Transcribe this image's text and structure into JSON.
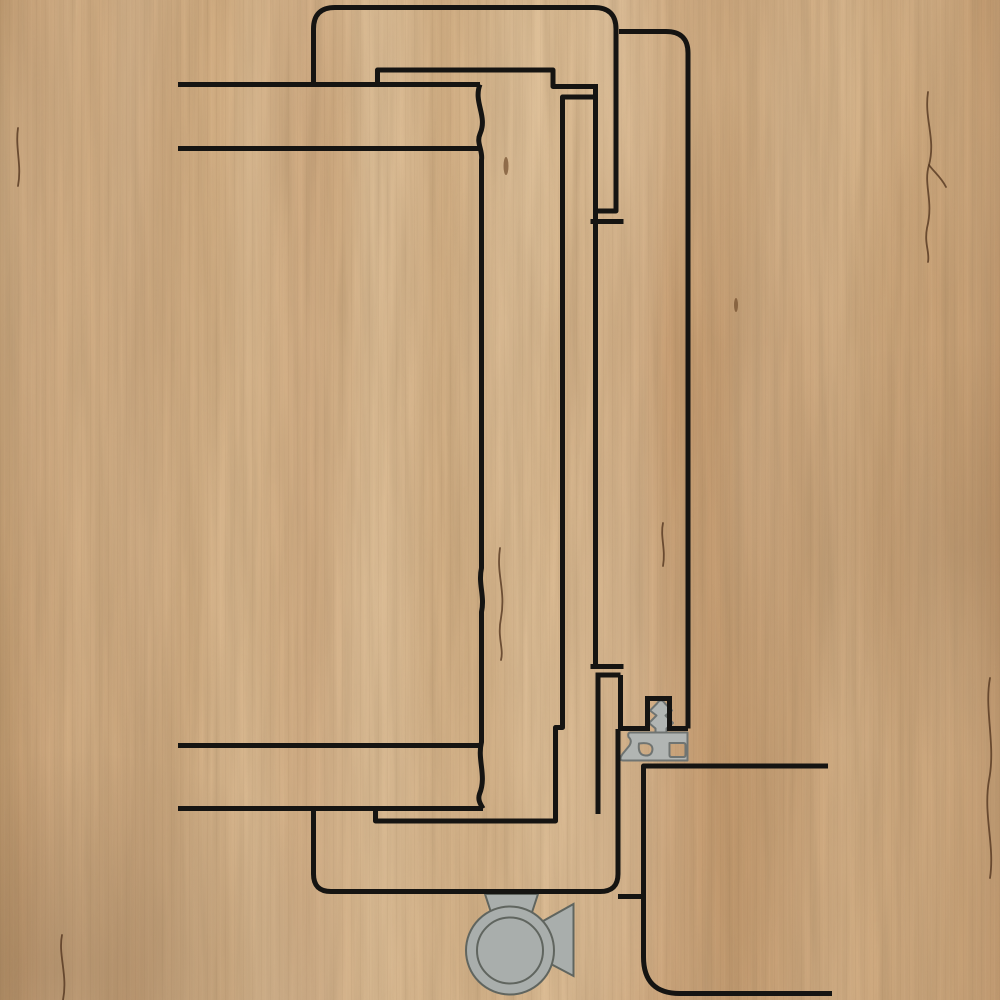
{
  "diagram": {
    "type": "technical-cross-section",
    "subject": "door-frame-profile-section-with-seal-and-hinge",
    "colors": {
      "line": "#151412",
      "seal_fill": "#b1b5b3",
      "seal_stroke": "#6f7472",
      "hinge_fill": "#a9aeac",
      "hinge_stroke": "#60655f",
      "wood_base": "#c9a478",
      "crack": "#54361f",
      "knot": "#6b4726"
    },
    "stroke_width": 5,
    "outline_paths": [
      {
        "name": "casing-inner-outline",
        "d": "M 313.5,86 V 29 Q 313.5,7.5 335,7.5 H 594 Q 616,7.5 616,29 V 211 H 596"
      },
      {
        "name": "rebate-cap-outer-top",
        "d": "M 590.5,221.5 H 623.5"
      },
      {
        "name": "rebate-line-upper",
        "d": "M 595.5,84 V 664.5"
      },
      {
        "name": "rebate-cap-outer-bottom",
        "d": "M 590.5,666.5 H 623.5"
      },
      {
        "name": "rebate-cap-inner-bottom",
        "d": "M 595.5,675 H 620.5"
      },
      {
        "name": "rebate-line-lower",
        "d": "M 598,675 V 814"
      },
      {
        "name": "rebate-wall-right-lower",
        "d": "M 620.5,675 V 728"
      },
      {
        "name": "casing-outer-outline",
        "d": "M 619,31.5 H 666 Q 688,31.5 688,53 V 728.5"
      },
      {
        "name": "seal-shelf-right",
        "d": "M 688,728.5 H 669.5"
      },
      {
        "name": "seal-groove-right-wall",
        "d": "M 669.5,731 V 698.5"
      },
      {
        "name": "seal-groove-cap",
        "d": "M 672,698.5 H 645"
      },
      {
        "name": "seal-groove-left-wall",
        "d": "M 647.5,698.5 V 731"
      },
      {
        "name": "seal-shelf-left",
        "d": "M 649.5,728.5 H 618"
      },
      {
        "name": "frame-foot-outline",
        "d": "M 313.5,809 V 874 Q 313.5,891.5 331,891.5 H 600 Q 618,891.5 618,874 V 729"
      },
      {
        "name": "frame-foot-step",
        "d": "M 618,896.5 H 644"
      },
      {
        "name": "frame-foot-outer",
        "d": "M 828,766 H 643.5 V 957 Q 643.5,993.5 680,993.5 H 832"
      },
      {
        "name": "leaf-face-top",
        "d": "M 178,84.5 H 480"
      },
      {
        "name": "leaf-break-edge",
        "d": "M 480,84.5 C 473,102 488,116 480,134 C 476,143 483,150 481.5,160 L 481.5,568 C 478,584 485,596 481.5,612 L 481.5,742 C 477,760 487,776 479.5,794 C 477.5,800 480.5,804 483,808.5"
      },
      {
        "name": "leaf-inner-top",
        "d": "M 178,148.5 H 481"
      },
      {
        "name": "leaf-inner-bottom",
        "d": "M 178,745.5 H 481"
      },
      {
        "name": "leaf-face-bottom",
        "d": "M 178,808.5 H 483"
      },
      {
        "name": "leaf-rebate-step-top",
        "d": "M 377.5,84.5 V 70 H 553 V 86.5 H 595.5"
      },
      {
        "name": "leaf-rebate-step-bottom",
        "d": "M 595.5,97 H 562.5 V 727.5 H 555.5 V 821 H 375.5 V 808.5"
      }
    ],
    "seal": {
      "body_d": "M 630,732.5 H 687.5 V 760.5 H 624 Q 618,761 622.5,754 L 629.5,745.5 Q 632.5,740.5 628.5,737 Q 627.5,733 630,732.5 Z M 639,743.5 Q 652,741.5 652.5,749 Q 652,756 645.5,755.5 Q 637.5,755 639,743.5 Z M 669.5,743 H 683.5 Q 685.5,743 685.5,745 V 755 Q 685.5,757 683.5,757 H 671.5 Q 669.5,757 669.5,755 Z",
      "foot_d": "M 655.5,734 V 728.5 L 649,723 L 656.5,715.5 L 650,710.5 L 657,703.5 Q 661,697.5 665,703.5 L 672,710.5 L 665.5,715.5 L 673,723 L 666.5,728.5 V 734 Z"
    },
    "hinge": {
      "cx": 510,
      "cy": 950.5,
      "r_outer": 44,
      "r_inner": 33,
      "flag_top_d": "M 485,894 H 538 L 529.5,920 H 493.5 Z",
      "flag_right_d": "M 573.5,904 V 976 L 540.5,958.5 V 922.5 Z"
    },
    "texture": {
      "cracks": [
        "M 928,92 C 924,120 936,138 929,165 C 923,185 934,200 927,228 C 924,244 930,252 928,262",
        "M 929,165 C 934,172 941,177 946,187",
        "M 500,548 C 496,575 506,590 501,618 C 497,638 504,648 501,660",
        "M 990,678 C 984,710 996,745 989,780 C 983,815 995,845 990,878",
        "M 663,523 C 660,537 666,549 663,566",
        "M 62,935 C 58,955 68,975 63,1000",
        "M 18,128 C 15,148 22,165 18,186"
      ],
      "knots": [
        {
          "cx": 506,
          "cy": 166,
          "rx": 2.5,
          "ry": 9
        },
        {
          "cx": 736,
          "cy": 305,
          "rx": 2,
          "ry": 7
        }
      ]
    }
  }
}
